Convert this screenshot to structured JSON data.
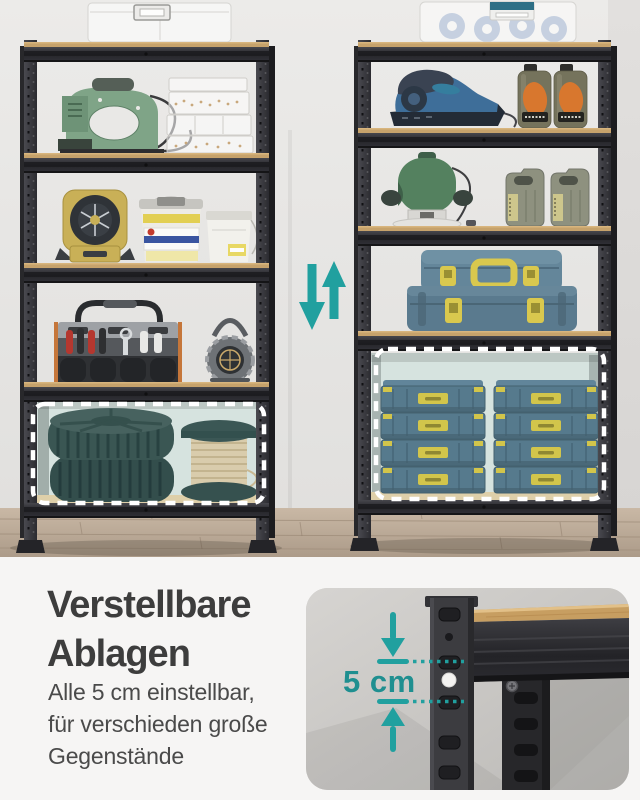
{
  "caption": {
    "heading_line1": "Verstellbare",
    "heading_line2": "Ablagen",
    "body_line1": "Alle 5 cm einstellbar,",
    "body_line2": "für verschieden große",
    "body_line3": "Gegenstände"
  },
  "detail_card": {
    "measurement_label": "5 cm"
  },
  "colors": {
    "accent_teal_arrows": "#21A09F",
    "accent_teal_text": "#1F8F90",
    "heading_text": "#3D3D3D",
    "body_text": "#4A4A4A",
    "highlight_dash": "#FFFFFF",
    "page_background": "#F6F5F4",
    "shelf_metal": "#2C2C31",
    "shelf_wood": "#C6A26B"
  },
  "scene": {
    "left_unit_items": [
      "translucent-storage-boxes",
      "electric-stapler",
      "clear-hardware-boxes",
      "portable-fan-light",
      "paint-bucket",
      "paint-can",
      "tool-tote-with-tools",
      "cable-reel",
      "stacked-tires",
      "wire-spool"
    ],
    "right_unit_items": [
      "bin-with-tape-rolls",
      "orbital-sander",
      "motor-oil-bottles",
      "plunge-router",
      "jerry-cans",
      "stacked-toolboxes",
      "organizer-case-stacks"
    ],
    "highlighted_compartment": "bottom shelf, white dashed outline",
    "adjustability_arrows": "teal up and down arrows between units"
  }
}
